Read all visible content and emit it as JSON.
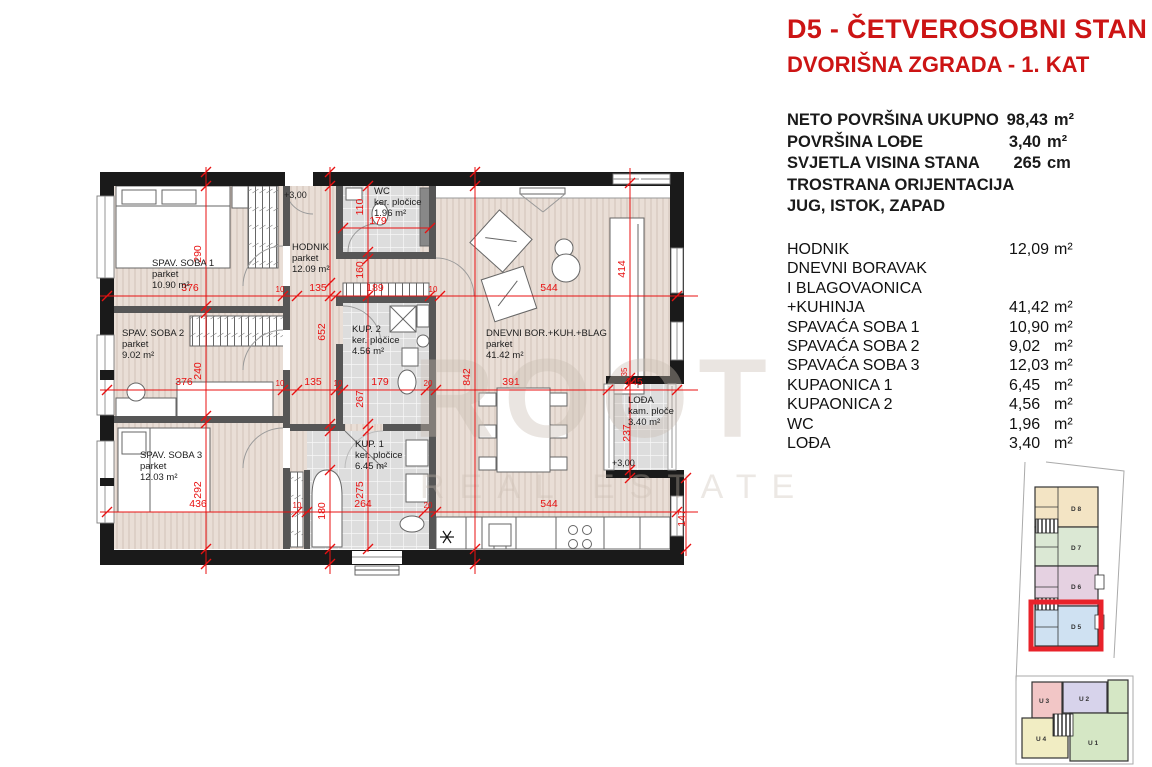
{
  "header": {
    "title": "D5 - ČETVEROSOBNI STAN",
    "subtitle": "DVORIŠNA ZGRADA - 1. KAT"
  },
  "summary": {
    "rows": [
      {
        "label": "NETO POVRŠINA UKUPNO",
        "value": "98,43",
        "unit": "m²"
      },
      {
        "label": "POVRŠINA LOĐE",
        "value": "3,40",
        "unit": "m²"
      },
      {
        "label": "SVJETLA VISINA STANA",
        "value": "265",
        "unit": "cm"
      },
      {
        "label": "TROSTRANA ORIJENTACIJA",
        "value": "",
        "unit": ""
      },
      {
        "label": "JUG, ISTOK, ZAPAD",
        "value": "",
        "unit": ""
      }
    ]
  },
  "room_list": {
    "rows": [
      {
        "label": "HODNIK",
        "value": "12,09",
        "unit": "m²"
      },
      {
        "label": "DNEVNI BORAVAK",
        "value": "",
        "unit": ""
      },
      {
        "label": "I BLAGOVAONICA",
        "value": "",
        "unit": ""
      },
      {
        "label": "+KUHINJA",
        "value": "41,42",
        "unit": "m²"
      },
      {
        "label": "SPAVAĆA SOBA 1",
        "value": "10,90",
        "unit": "m²"
      },
      {
        "label": "SPAVAĆA SOBA 2",
        "value": "9,02",
        "unit": "m²"
      },
      {
        "label": "SPAVAĆA SOBA 3",
        "value": "12,03",
        "unit": "m²"
      },
      {
        "label": "KUPAONICA 1",
        "value": "6,45",
        "unit": "m²"
      },
      {
        "label": "KUPAONICA 2",
        "value": "4,56",
        "unit": "m²"
      },
      {
        "label": "WC",
        "value": "1,96",
        "unit": "m²"
      },
      {
        "label": "LOĐA",
        "value": "3,40",
        "unit": "m²"
      }
    ]
  },
  "watermark": {
    "line1": "ROOT",
    "line2": "REAL ESTATE"
  },
  "plan": {
    "rooms": [
      {
        "name": "SPAV. SOBA 1",
        "floor": "parket",
        "area": "10.90 m²",
        "x": 152,
        "y": 266
      },
      {
        "name": "SPAV. SOBA 2",
        "floor": "parket",
        "area": "9.02 m²",
        "x": 122,
        "y": 336
      },
      {
        "name": "SPAV. SOBA 3",
        "floor": "parket",
        "area": "12.03 m²",
        "x": 140,
        "y": 458
      },
      {
        "name": "HODNIK",
        "floor": "parket",
        "area": "12.09 m²",
        "x": 292,
        "y": 250
      },
      {
        "name": "WC",
        "floor": "ker. pločice",
        "area": "1.96 m²",
        "x": 374,
        "y": 194
      },
      {
        "name": "KUP. 2",
        "floor": "ker. pločice",
        "area": "4.56 m²",
        "x": 352,
        "y": 332
      },
      {
        "name": "KUP. 1",
        "floor": "ker. pločice",
        "area": "6.45 m²",
        "x": 355,
        "y": 447
      },
      {
        "name": "DNEVNI BOR.+KUH.+BLAG",
        "floor": "parket",
        "area": "41.42 m²",
        "x": 486,
        "y": 336
      },
      {
        "name": "LOĐA",
        "floor": "kam. ploče",
        "area": "3.40 m²",
        "x": 628,
        "y": 403
      }
    ],
    "levels": [
      {
        "t": "+3,00",
        "x": 284,
        "y": 198
      },
      {
        "t": "+3,00",
        "x": 612,
        "y": 466
      }
    ],
    "dimensions": [
      {
        "t": "376",
        "x": 190,
        "y": 291
      },
      {
        "t": "10",
        "x": 280,
        "y": 292,
        "s": 1
      },
      {
        "t": "135",
        "x": 318,
        "y": 291
      },
      {
        "t": "189",
        "x": 375,
        "y": 291
      },
      {
        "t": "10",
        "x": 433,
        "y": 292,
        "s": 1
      },
      {
        "t": "544",
        "x": 549,
        "y": 291
      },
      {
        "t": "376",
        "x": 184,
        "y": 385
      },
      {
        "t": "10",
        "x": 280,
        "y": 386,
        "s": 1
      },
      {
        "t": "135",
        "x": 313,
        "y": 385
      },
      {
        "t": "10",
        "x": 338,
        "y": 386,
        "s": 1
      },
      {
        "t": "179",
        "x": 380,
        "y": 385
      },
      {
        "t": "20",
        "x": 428,
        "y": 386,
        "s": 1
      },
      {
        "t": "391",
        "x": 511,
        "y": 385
      },
      {
        "t": "145",
        "x": 634,
        "y": 385
      },
      {
        "t": "436",
        "x": 198,
        "y": 507
      },
      {
        "t": "10",
        "x": 297,
        "y": 508,
        "s": 1
      },
      {
        "t": "264",
        "x": 363,
        "y": 507
      },
      {
        "t": "20",
        "x": 428,
        "y": 508,
        "s": 1
      },
      {
        "t": "544",
        "x": 549,
        "y": 507
      },
      {
        "t": "290",
        "x": 201,
        "y": 254,
        "r": 1
      },
      {
        "t": "240",
        "x": 201,
        "y": 371,
        "r": 1
      },
      {
        "t": "292",
        "x": 201,
        "y": 490,
        "r": 1
      },
      {
        "t": "652",
        "x": 325,
        "y": 332,
        "r": 1
      },
      {
        "t": "180",
        "x": 325,
        "y": 511,
        "r": 1
      },
      {
        "t": "110",
        "x": 363,
        "y": 207,
        "r": 1
      },
      {
        "t": "160",
        "x": 363,
        "y": 270,
        "r": 1
      },
      {
        "t": "267",
        "x": 363,
        "y": 399,
        "r": 1
      },
      {
        "t": "275",
        "x": 363,
        "y": 490,
        "r": 1
      },
      {
        "t": "842",
        "x": 470,
        "y": 377,
        "r": 1
      },
      {
        "t": "414",
        "x": 625,
        "y": 269,
        "r": 1
      },
      {
        "t": "35",
        "x": 627,
        "y": 372,
        "r": 1,
        "s": 1
      },
      {
        "t": "237",
        "x": 630,
        "y": 433,
        "r": 1
      },
      {
        "t": "147",
        "x": 685,
        "y": 518,
        "r": 1
      },
      {
        "t": "179",
        "x": 378,
        "y": 224
      }
    ]
  },
  "site_plan": {
    "highlight_color": "#e8222a",
    "upper_units": [
      {
        "id": "D 8",
        "x": 1035,
        "y": 487,
        "w": 63,
        "h": 40,
        "color": "#f3e4c4",
        "lx": 1076,
        "ly": 511
      },
      {
        "id": "D 7",
        "x": 1035,
        "y": 527,
        "w": 63,
        "h": 39,
        "color": "#dbe8d4",
        "lx": 1076,
        "ly": 550
      },
      {
        "id": "D 6",
        "x": 1035,
        "y": 566,
        "w": 63,
        "h": 40,
        "color": "#e5d1e1",
        "lx": 1076,
        "ly": 589
      },
      {
        "id": "D 5",
        "x": 1035,
        "y": 606,
        "w": 63,
        "h": 40,
        "color": "#cfe1f2",
        "lx": 1076,
        "ly": 629
      }
    ],
    "lower_units": [
      {
        "id": "U 3",
        "x": 1032,
        "y": 682,
        "w": 30,
        "h": 36,
        "color": "#f2c6c6",
        "lx": 1044,
        "ly": 703
      },
      {
        "id": "U 2",
        "x": 1063,
        "y": 682,
        "w": 44,
        "h": 31,
        "color": "#d7d3eb",
        "lx": 1084,
        "ly": 701
      },
      {
        "id": "U 4",
        "x": 1022,
        "y": 718,
        "w": 46,
        "h": 40,
        "color": "#f1edc3",
        "lx": 1041,
        "ly": 741
      },
      {
        "id": "U 1",
        "x": 1070,
        "y": 713,
        "w": 58,
        "h": 48,
        "color": "#d5e7c5",
        "lx": 1093,
        "ly": 745
      },
      {
        "id": "",
        "x": 1108,
        "y": 680,
        "w": 20,
        "h": 33,
        "color": "#d5e7c5",
        "lx": 0,
        "ly": 0
      }
    ]
  },
  "colors": {
    "accent_red": "#cc1414",
    "dimension_red": "#e81111",
    "wall_dark": "#1a1a1a",
    "wall_gray": "#565656",
    "parquet": "#e9ded6",
    "tile": "#dddddd"
  }
}
